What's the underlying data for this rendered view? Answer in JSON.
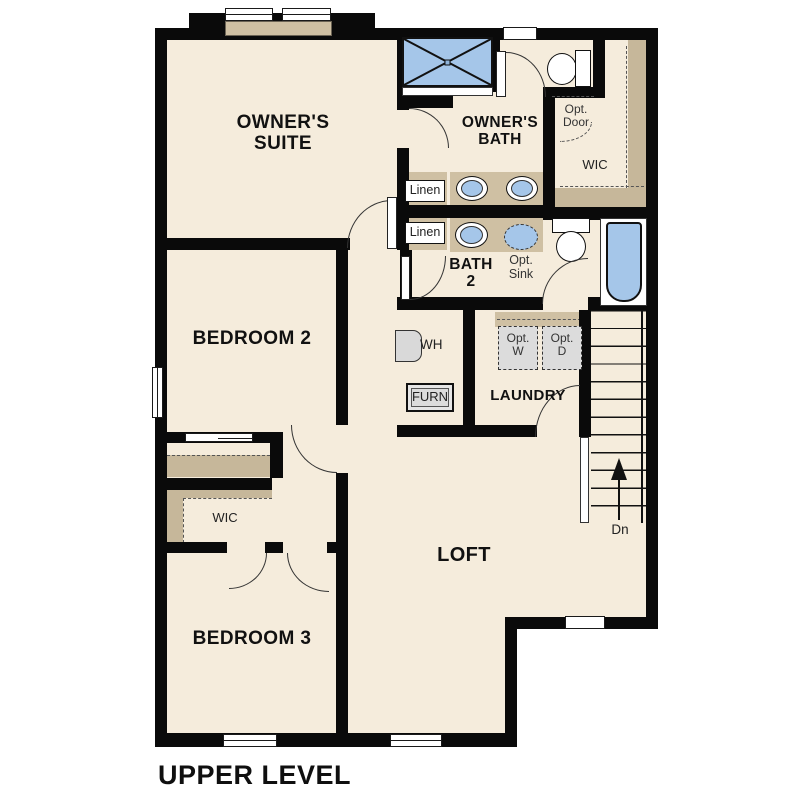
{
  "title": {
    "label": "UPPER LEVEL"
  },
  "colors": {
    "floor": "#f5ecdc",
    "wall": "#0a0a0a",
    "counter_tan": "#cfc0a3",
    "closet_tan": "#c6b79a",
    "fixture_blue": "#a5c6e9",
    "optional_gray": "#dcdcdc"
  },
  "rooms": {
    "owners_suite": "OWNER'S SUITE",
    "owners_bath": "OWNER'S BATH",
    "wic_upper": "WIC",
    "bath2": "BATH 2",
    "bedroom2": "BEDROOM 2",
    "bedroom3": "BEDROOM 3",
    "wic_lower": "WIC",
    "laundry": "LAUNDRY",
    "loft": "LOFT"
  },
  "fixtures": {
    "linen_upper": "Linen",
    "linen_lower": "Linen",
    "opt_door": "Opt. Door",
    "opt_sink": "Opt. Sink",
    "opt_washer": "Opt. W",
    "opt_dryer": "Opt. D",
    "water_heater": "WH",
    "furnace": "FURN",
    "stair_direction": "Dn"
  }
}
